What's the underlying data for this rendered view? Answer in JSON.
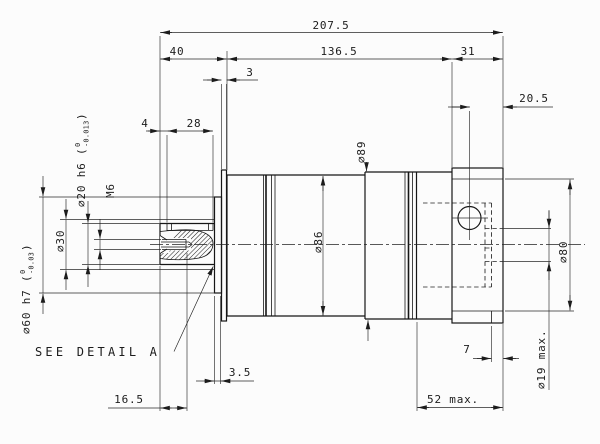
{
  "dims": {
    "overall": "207.5",
    "front": "40",
    "middle": "136.5",
    "flange_w": "31",
    "plate": "3",
    "hole_offset": "20.5",
    "key_offset": "4",
    "key_len": "28",
    "shaft": "∅20 h6 (",
    "shaft_hi": "0",
    "shaft_lo": "-0.013",
    "shaft_end": ")",
    "thread": "M6",
    "collar": "∅30",
    "pilot": "∅60 h7 (",
    "pilot_hi": "0",
    "pilot_lo": "-0.03",
    "pilot_end": ")",
    "ring": "∅89",
    "body": "∅86",
    "flange": "∅80",
    "bore": "∅19 max.",
    "bore_step": "7",
    "boss": "3.5",
    "thread_depth": "16.5",
    "motor": "52 max.",
    "note": "SEE DETAIL A"
  }
}
